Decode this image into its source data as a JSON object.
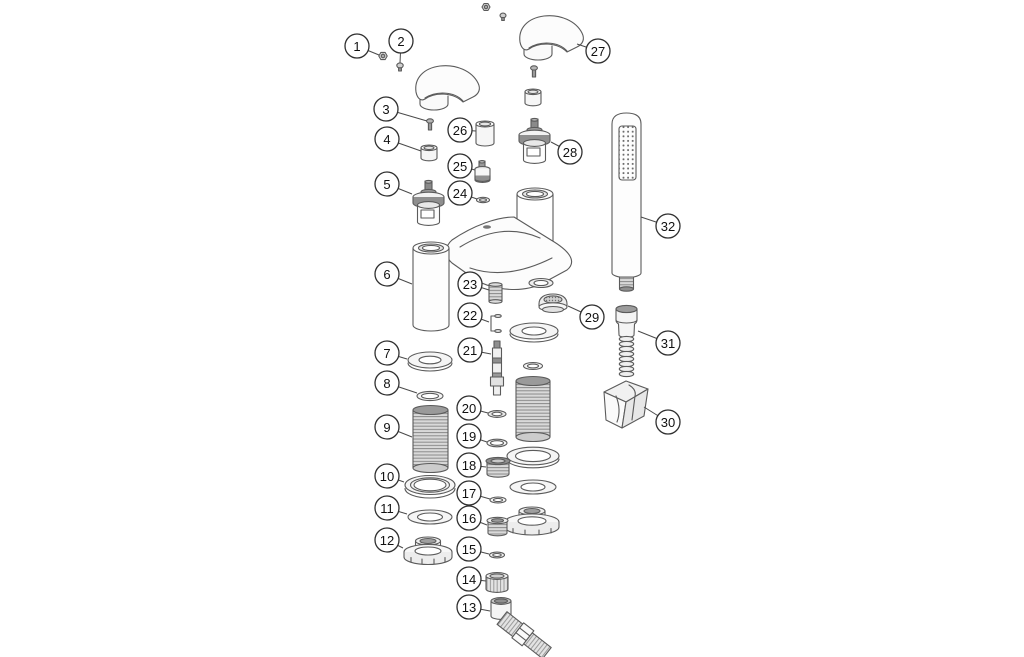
{
  "colors": {
    "background": "#ffffff",
    "line_art_stroke": "#5b5b5b",
    "callout_stroke": "#2f2f2f",
    "callout_text": "#111111",
    "leader_line": "#4a4a4a"
  },
  "callouts": [
    {
      "label": "1",
      "x": 357,
      "y": 46,
      "tx": 379,
      "ty": 55
    },
    {
      "label": "2",
      "x": 401,
      "y": 41,
      "tx": 400,
      "ty": 63
    },
    {
      "label": "3",
      "x": 386,
      "y": 109,
      "tx": 427,
      "ty": 121
    },
    {
      "label": "4",
      "x": 387,
      "y": 139,
      "tx": 421,
      "ty": 151
    },
    {
      "label": "5",
      "x": 387,
      "y": 184,
      "tx": 412,
      "ty": 194
    },
    {
      "label": "6",
      "x": 387,
      "y": 274,
      "tx": 412,
      "ty": 284
    },
    {
      "label": "7",
      "x": 387,
      "y": 353,
      "tx": 407,
      "ty": 359
    },
    {
      "label": "8",
      "x": 387,
      "y": 383,
      "tx": 417,
      "ty": 393
    },
    {
      "label": "9",
      "x": 387,
      "y": 427,
      "tx": 412,
      "ty": 437
    },
    {
      "label": "10",
      "x": 387,
      "y": 476,
      "tx": 404,
      "ty": 482
    },
    {
      "label": "11",
      "x": 387,
      "y": 508,
      "tx": 407,
      "ty": 514
    },
    {
      "label": "12",
      "x": 387,
      "y": 540,
      "tx": 403,
      "ty": 548
    },
    {
      "label": "13",
      "x": 469,
      "y": 607,
      "tx": 490,
      "ty": 611
    },
    {
      "label": "14",
      "x": 469,
      "y": 579,
      "tx": 486,
      "ty": 581
    },
    {
      "label": "15",
      "x": 469,
      "y": 549,
      "tx": 489,
      "ty": 554
    },
    {
      "label": "16",
      "x": 469,
      "y": 518,
      "tx": 487,
      "ty": 525
    },
    {
      "label": "17",
      "x": 469,
      "y": 493,
      "tx": 490,
      "ty": 499
    },
    {
      "label": "18",
      "x": 469,
      "y": 465,
      "tx": 486,
      "ty": 467
    },
    {
      "label": "19",
      "x": 469,
      "y": 436,
      "tx": 487,
      "ty": 442
    },
    {
      "label": "20",
      "x": 469,
      "y": 408,
      "tx": 488,
      "ty": 413
    },
    {
      "label": "21",
      "x": 470,
      "y": 350,
      "tx": 491,
      "ty": 354
    },
    {
      "label": "22",
      "x": 470,
      "y": 315,
      "tx": 489,
      "ty": 322
    },
    {
      "label": "23",
      "x": 470,
      "y": 284,
      "tx": 489,
      "ty": 290
    },
    {
      "label": "24",
      "x": 460,
      "y": 193,
      "tx": 477,
      "ty": 199
    },
    {
      "label": "25",
      "x": 460,
      "y": 166,
      "tx": 475,
      "ty": 170
    },
    {
      "label": "26",
      "x": 460,
      "y": 130,
      "tx": 476,
      "ty": 131
    },
    {
      "label": "27",
      "x": 598,
      "y": 51,
      "tx": 577,
      "ty": 44
    },
    {
      "label": "28",
      "x": 570,
      "y": 152,
      "tx": 551,
      "ty": 142
    },
    {
      "label": "29",
      "x": 592,
      "y": 317,
      "tx": 568,
      "ty": 306
    },
    {
      "label": "30",
      "x": 668,
      "y": 422,
      "tx": 644,
      "ty": 407
    },
    {
      "label": "31",
      "x": 668,
      "y": 343,
      "tx": 638,
      "ty": 331
    },
    {
      "label": "32",
      "x": 668,
      "y": 226,
      "tx": 641,
      "ty": 217
    }
  ]
}
